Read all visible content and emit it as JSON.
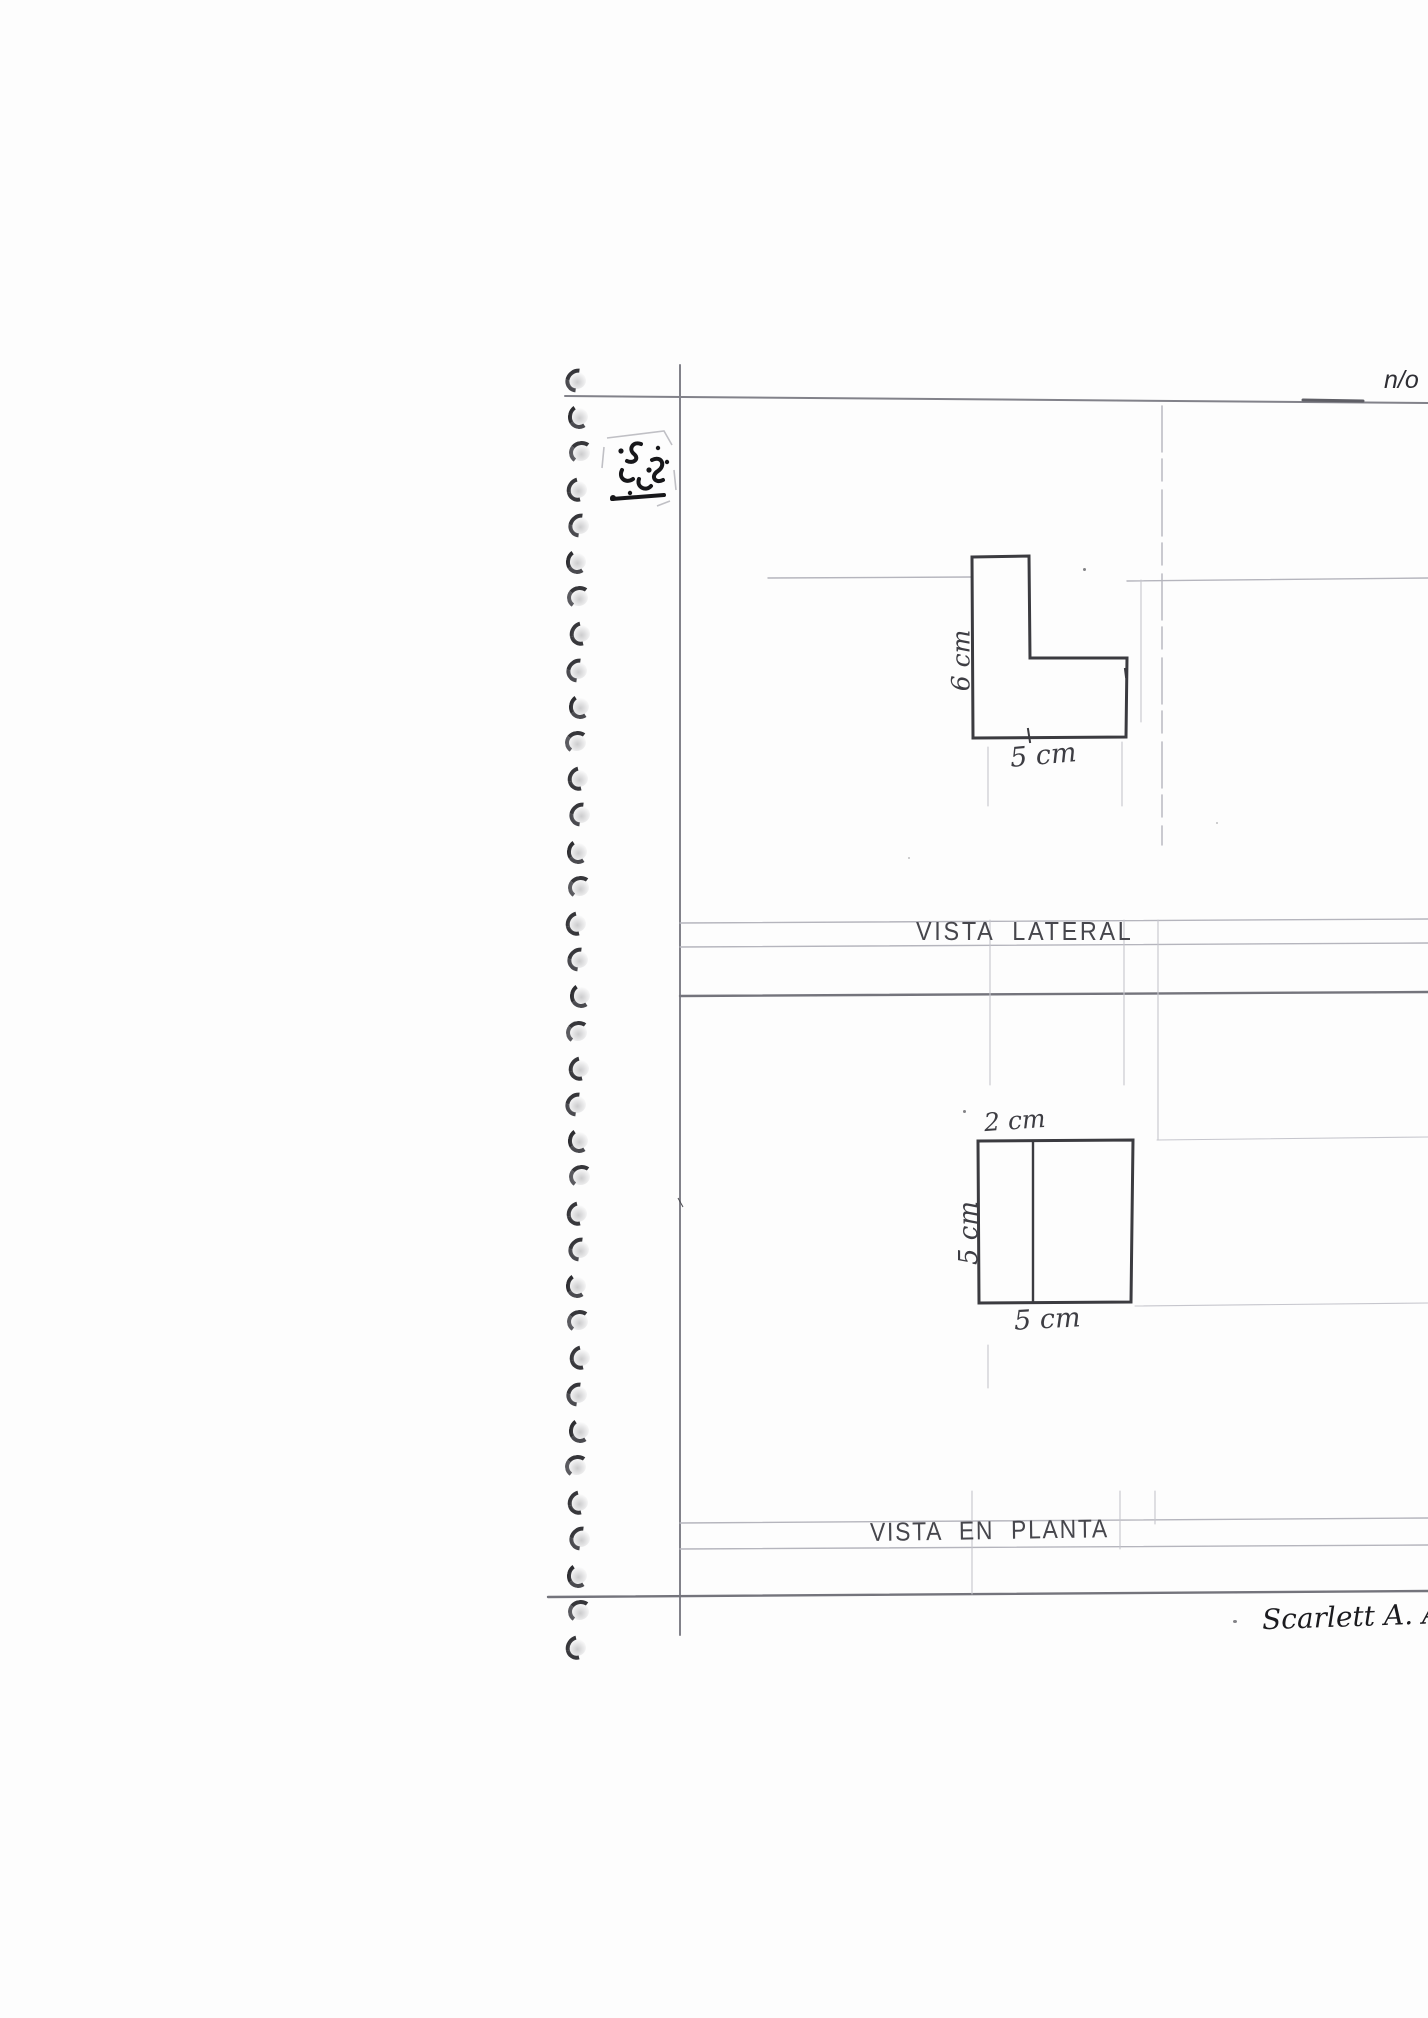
{
  "page_note": {
    "text": "n/o"
  },
  "lateral_view": {
    "caption": "VISTA LATERAL",
    "height_label": "6 cm",
    "width_label": "5 cm"
  },
  "plan_view": {
    "caption": "VISTA EN PLANTA",
    "top_label": "2 cm",
    "side_label": "5 cm",
    "bottom_label": "5 cm"
  },
  "signature": {
    "text": "Scarlett A. Al"
  },
  "spiral": {
    "count": 36
  },
  "colors": {
    "paper": "#fdfdfd",
    "pen_ink": "#3d3d43",
    "shape_ink": "#3b3b40",
    "guide_line": "#b5b5bd",
    "rule_line": "#82828a",
    "stamp_ink": "#17171a"
  }
}
